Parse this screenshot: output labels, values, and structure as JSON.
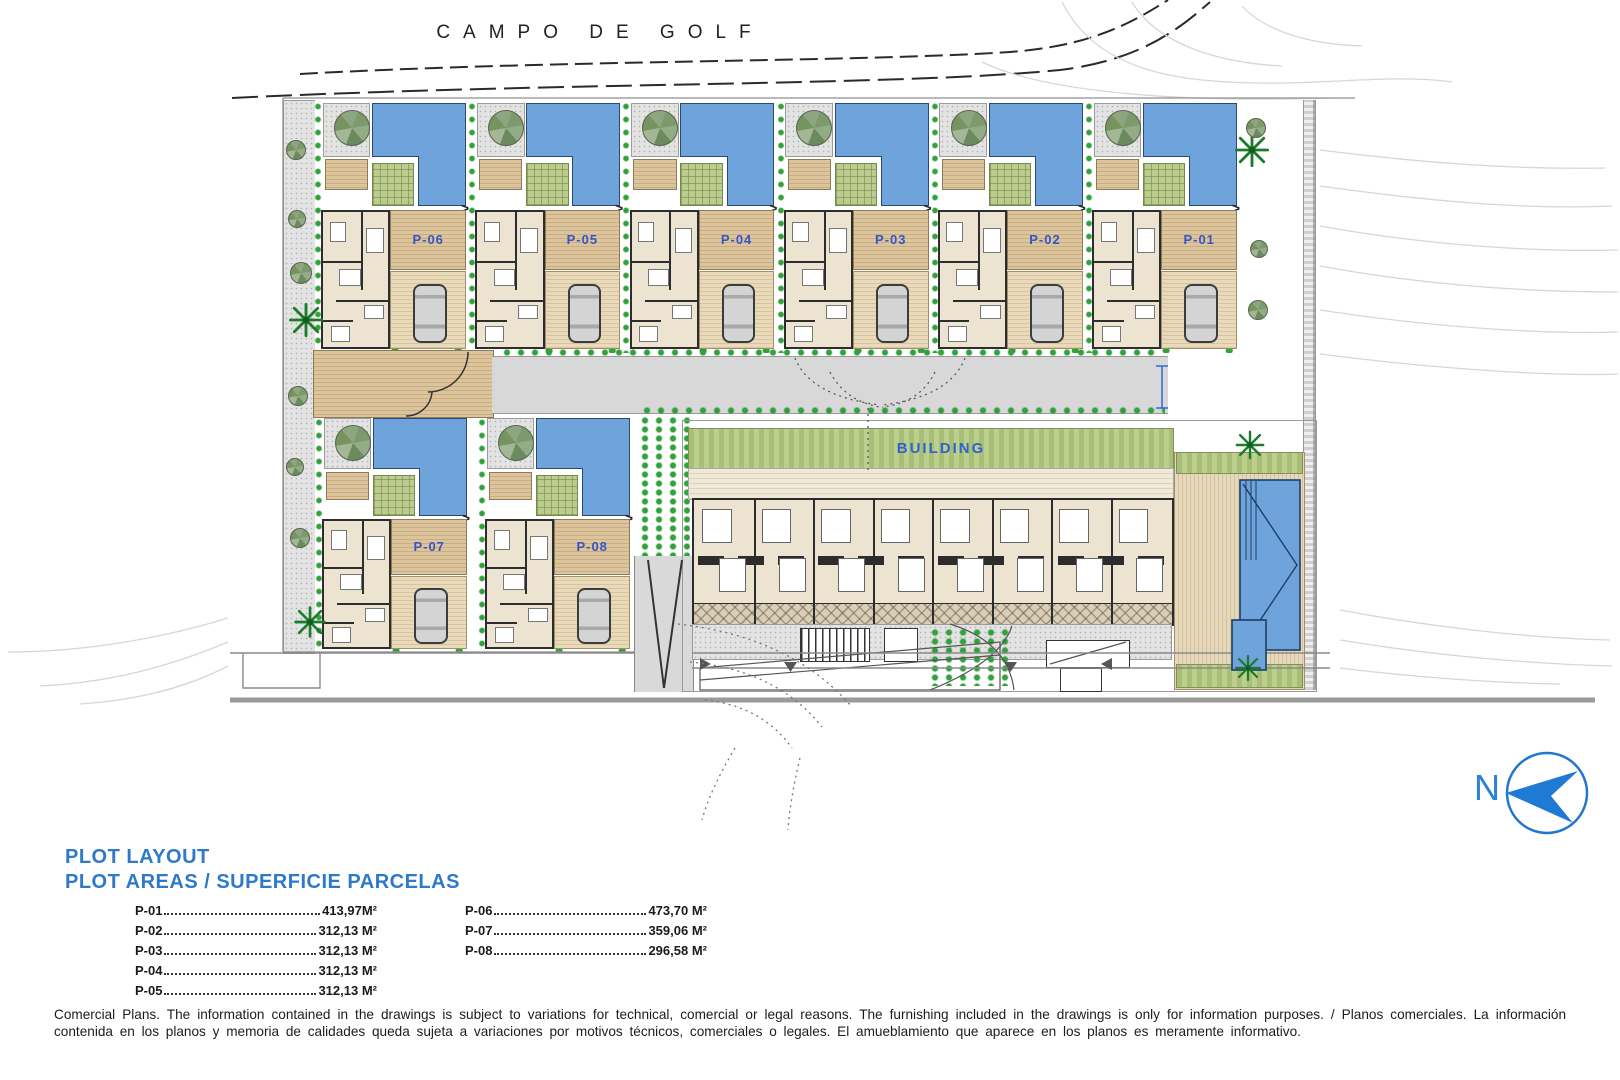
{
  "header": {
    "golf_label": "CAMPO DE GOLF"
  },
  "plan": {
    "top_row": [
      "P-06",
      "P-05",
      "P-04",
      "P-03",
      "P-02",
      "P-01"
    ],
    "bottom_row": [
      "P-07",
      "P-08"
    ],
    "building_label": "BUILDING",
    "entry_arrow": ">"
  },
  "compass": {
    "north_label": "N"
  },
  "legend": {
    "title_line1": "PLOT LAYOUT",
    "title_line2": "PLOT AREAS / SUPERFICIE PARCELAS",
    "column1": [
      {
        "plot": "P-01",
        "area": "413,97M²"
      },
      {
        "plot": "P-02",
        "area": "312,13 M²"
      },
      {
        "plot": "P-03",
        "area": "312,13 M²"
      },
      {
        "plot": "P-04",
        "area": "312,13 M²"
      },
      {
        "plot": "P-05",
        "area": "312,13 M²"
      }
    ],
    "column2": [
      {
        "plot": "P-06",
        "area": "473,70 M²"
      },
      {
        "plot": "P-07",
        "area": "359,06 M²"
      },
      {
        "plot": "P-08",
        "area": "296,58 M²"
      }
    ]
  },
  "disclaimer": "Comercial Plans. The information contained in the drawings is subject to variations for technical, comercial or legal reasons. The furnishing included in the drawings is only for information purposes. / Planos comerciales. La información contenida en los planos y memoria de calidades queda sujeta a variaciones por motivos técnicos, comerciales o legales. El amueblamiento que aparece en los planos es meramente informativo.",
  "colors": {
    "pool_blue": "#6fa3dc",
    "plot_label_blue": "#3655c6",
    "legend_blue": "#2e7ac8",
    "compass_blue": "#2b82d8",
    "deck_tan": "#d7bd93",
    "grass_green": "#bccb8e",
    "bush_green": "#2fa23a",
    "floor_cream": "#ece4d1"
  }
}
